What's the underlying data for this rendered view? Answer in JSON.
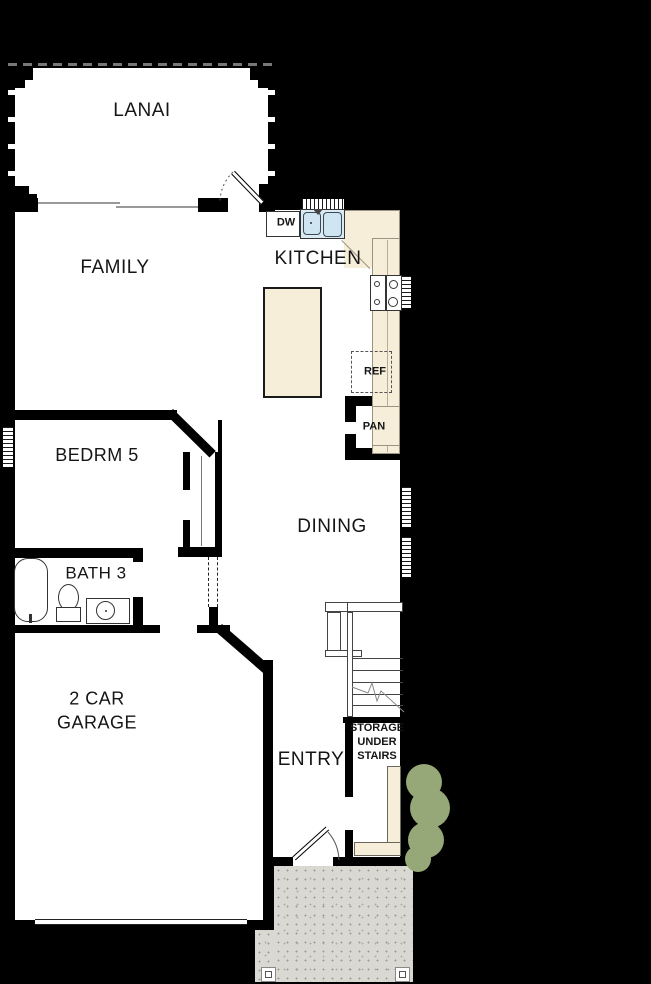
{
  "labels": {
    "lanai": "LANAI",
    "family": "FAMILY",
    "kitchen": "KITCHEN",
    "dining": "DINING",
    "bedroom5": "BEDRM 5",
    "bath3": "BATH 3",
    "garage_line1": "2 CAR",
    "garage_line2": "GARAGE",
    "entry": "ENTRY",
    "storage_line1": "STORAGE",
    "storage_line2": "UNDER",
    "storage_line3": "STAIRS",
    "dishwasher": "DW",
    "refrigerator": "REF",
    "pantry": "PAN"
  },
  "colors": {
    "background": "#000000",
    "wall": "#000000",
    "floor": "#ffffff",
    "counter_cream": "#f7eeda",
    "fixture_blue": "#d9eaf4",
    "shrub_green": "#97a878",
    "porch_gray": "#d9d8d3",
    "text": "#151515"
  }
}
